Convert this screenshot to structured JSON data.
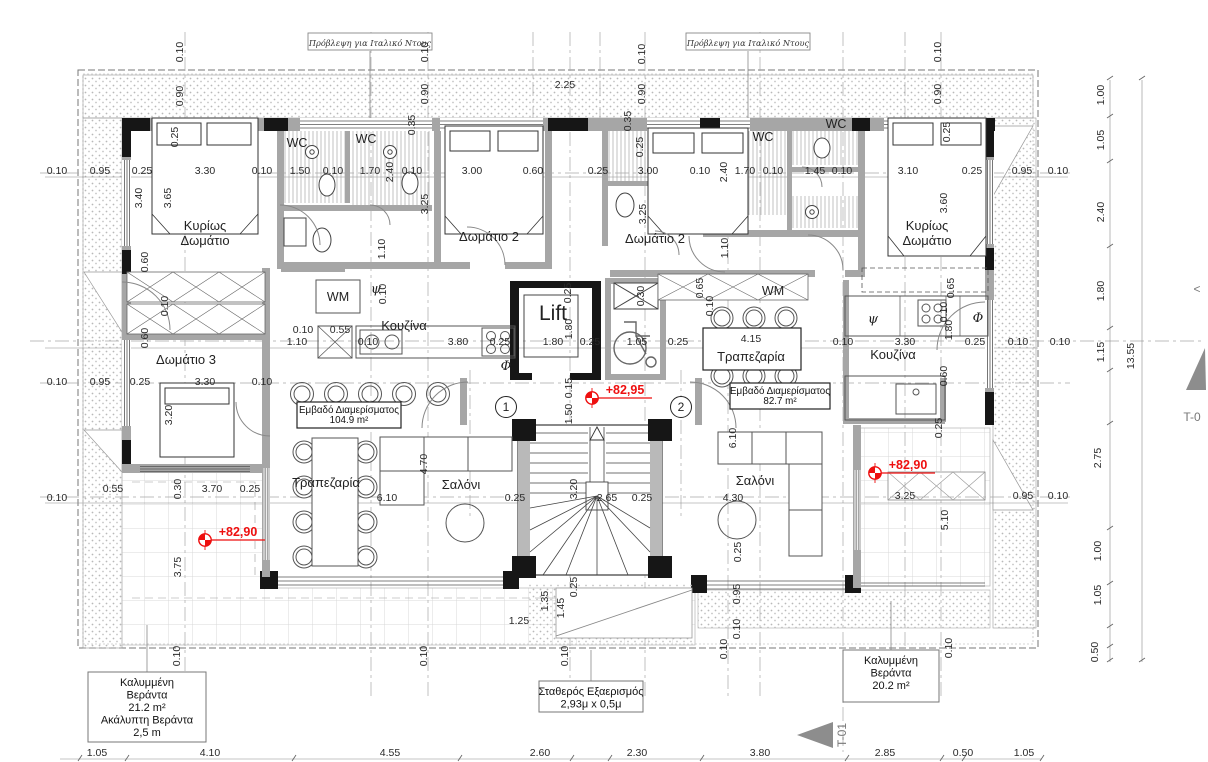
{
  "colors": {
    "accent_red": "#ee0f0f",
    "wall_gray": "#a6a6a6",
    "column_black": "#161616",
    "line_gray": "#8a8a8a"
  },
  "header_notes": [
    {
      "text": "Πρόβλεψη για Ιταλικό Ντους",
      "x": 370,
      "y": 43
    },
    {
      "text": "Πρόβλεψη για Ιταλικό Ντους",
      "x": 748,
      "y": 43
    }
  ],
  "rooms": [
    {
      "lines": [
        "Κυρίως",
        "Δωμάτιο"
      ],
      "x": 205,
      "y": 230
    },
    {
      "lines": [
        "Δωμάτιο 2"
      ],
      "x": 489,
      "y": 241
    },
    {
      "lines": [
        "Δωμάτιο 2"
      ],
      "x": 655,
      "y": 243
    },
    {
      "lines": [
        "Κυρίως",
        "Δωμάτιο"
      ],
      "x": 927,
      "y": 230
    },
    {
      "lines": [
        "Δωμάτιο 3"
      ],
      "x": 186,
      "y": 364
    },
    {
      "lines": [
        "Κουζίνα"
      ],
      "x": 404,
      "y": 330
    },
    {
      "lines": [
        "Κουζίνα"
      ],
      "x": 893,
      "y": 359
    },
    {
      "lines": [
        "Τραπεζαρία"
      ],
      "x": 326,
      "y": 487
    },
    {
      "lines": [
        "Τραπεζαρία"
      ],
      "x": 751,
      "y": 361
    },
    {
      "lines": [
        "Σαλόνι"
      ],
      "x": 461,
      "y": 489
    },
    {
      "lines": [
        "Σαλόνι"
      ],
      "x": 755,
      "y": 485
    }
  ],
  "fixtures": [
    {
      "t": "Lift",
      "x": 553,
      "y": 320,
      "cls": "lift"
    },
    {
      "t": "WC",
      "x": 297,
      "y": 147,
      "cls": "fixture"
    },
    {
      "t": "WC",
      "x": 366,
      "y": 143,
      "cls": "fixture"
    },
    {
      "t": "WC",
      "x": 763,
      "y": 141,
      "cls": "fixture"
    },
    {
      "t": "WC",
      "x": 836,
      "y": 128,
      "cls": "fixture"
    },
    {
      "t": "WM",
      "x": 338,
      "y": 301,
      "cls": "fixture"
    },
    {
      "t": "WM",
      "x": 773,
      "y": 295,
      "cls": "fixture"
    },
    {
      "t": "ψ",
      "x": 376,
      "y": 293,
      "cls": "greek-sym"
    },
    {
      "t": "ψ",
      "x": 873,
      "y": 323,
      "cls": "greek-sym"
    },
    {
      "t": "Φ",
      "x": 506,
      "y": 370,
      "cls": "greek-sym"
    },
    {
      "t": "Φ",
      "x": 978,
      "y": 322,
      "cls": "greek-sym"
    }
  ],
  "area_tags": [
    {
      "lines": [
        "Εμβαδό Διαμερίσματος",
        "104.9 m²"
      ],
      "x": 349,
      "y": 402,
      "w": 104,
      "h": 26
    },
    {
      "lines": [
        "Εμβαδό Διαμερίσματος",
        "82.7 m²"
      ],
      "x": 780,
      "y": 383,
      "w": 100,
      "h": 26
    }
  ],
  "info_boxes": [
    {
      "lines": [
        "Καλυμμένη",
        "Βεράντα",
        "21.2 m²",
        "Ακάλυπτη Βεράντα",
        "2,5 m"
      ],
      "x": 147,
      "y": 672,
      "w": 118,
      "h": 70,
      "leader": [
        147,
        625,
        147,
        672
      ]
    },
    {
      "lines": [
        "Σταθερός Εξαερισμός",
        "2,93μ x 0,5μ"
      ],
      "x": 591,
      "y": 681,
      "w": 104,
      "h": 31,
      "leader": [
        591,
        650,
        591,
        681
      ]
    },
    {
      "lines": [
        "Καλυμμένη",
        "Βεράντα",
        "20.2 m²"
      ],
      "x": 891,
      "y": 650,
      "w": 96,
      "h": 52,
      "leader": [
        891,
        601,
        891,
        650
      ]
    }
  ],
  "elevations": [
    {
      "t": "+82,95",
      "x": 592,
      "y": 398
    },
    {
      "t": "+82,90",
      "x": 875,
      "y": 473
    },
    {
      "t": "+82,90",
      "x": 205,
      "y": 540
    }
  ],
  "grid_bubbles": [
    {
      "t": "1",
      "x": 506,
      "y": 407
    },
    {
      "t": "2",
      "x": 681,
      "y": 407
    }
  ],
  "section_markers": [
    {
      "t": "T-01",
      "x": 846,
      "y": 735,
      "rot": -90,
      "tri": "833,722 833,748 797,735"
    },
    {
      "t": "T-0",
      "x": 1192,
      "y": 421,
      "rot": 0,
      "tri": "1205,348 1186,390 1206,390"
    },
    {
      "t": "<",
      "x": 1197,
      "y": 293,
      "rot": 0
    }
  ],
  "dims_h": [
    [
      "2.25",
      565,
      88
    ],
    [
      "0.10",
      57,
      174
    ],
    [
      "0.95",
      100,
      174
    ],
    [
      "0.25",
      142,
      174
    ],
    [
      "3.30",
      205,
      174
    ],
    [
      "0.10",
      262,
      174
    ],
    [
      "1.50",
      300,
      174
    ],
    [
      "0.10",
      333,
      174
    ],
    [
      "1.70",
      370,
      174
    ],
    [
      "0.10",
      412,
      174
    ],
    [
      "3.00",
      472,
      174
    ],
    [
      "0.60",
      533,
      174
    ],
    [
      "0.25",
      598,
      174
    ],
    [
      "3.00",
      648,
      174
    ],
    [
      "0.10",
      700,
      174
    ],
    [
      "1.70",
      745,
      174
    ],
    [
      "0.10",
      773,
      174
    ],
    [
      "1.45",
      815,
      174
    ],
    [
      "0.10",
      842,
      174
    ],
    [
      "3.10",
      908,
      174
    ],
    [
      "0.25",
      972,
      174
    ],
    [
      "0.95",
      1022,
      174
    ],
    [
      "0.10",
      1058,
      174
    ],
    [
      "0.10",
      303,
      333
    ],
    [
      "0.55",
      340,
      333
    ],
    [
      "1.10",
      297,
      345
    ],
    [
      "0.10",
      368,
      345
    ],
    [
      "3.80",
      458,
      345
    ],
    [
      "0.25",
      500,
      345
    ],
    [
      "1.80",
      553,
      345
    ],
    [
      "0.25",
      590,
      345
    ],
    [
      "1.05",
      637,
      345
    ],
    [
      "0.25",
      678,
      345
    ],
    [
      "4.15",
      751,
      342
    ],
    [
      "0.10",
      843,
      345
    ],
    [
      "3.30",
      905,
      345
    ],
    [
      "0.25",
      975,
      345
    ],
    [
      "0.10",
      1018,
      345
    ],
    [
      "0.10",
      1060,
      345
    ],
    [
      "0.10",
      57,
      385
    ],
    [
      "0.95",
      100,
      385
    ],
    [
      "0.25",
      140,
      385
    ],
    [
      "3.30",
      205,
      385
    ],
    [
      "0.10",
      262,
      385
    ],
    [
      "0.55",
      113,
      492
    ],
    [
      "3.70",
      212,
      492
    ],
    [
      "0.25",
      250,
      492
    ],
    [
      "0.10",
      57,
      501
    ],
    [
      "6.10",
      387,
      501
    ],
    [
      "0.25",
      515,
      501
    ],
    [
      "2.65",
      607,
      501
    ],
    [
      "0.25",
      642,
      501
    ],
    [
      "4.30",
      733,
      501
    ],
    [
      "3.25",
      905,
      499
    ],
    [
      "0.95",
      1023,
      499
    ],
    [
      "0.10",
      1058,
      499
    ],
    [
      "1.25",
      519,
      624
    ],
    [
      "1.05",
      97,
      756
    ],
    [
      "4.10",
      210,
      756
    ],
    [
      "4.55",
      390,
      756
    ],
    [
      "2.60",
      540,
      756
    ],
    [
      "2.30",
      637,
      756
    ],
    [
      "3.80",
      760,
      756
    ],
    [
      "2.85",
      885,
      756
    ],
    [
      "0.50",
      963,
      756
    ],
    [
      "1.05",
      1024,
      756
    ]
  ],
  "dims_v": [
    [
      "0.10",
      183,
      52
    ],
    [
      "0.90",
      183,
      96
    ],
    [
      "0.25",
      178,
      137
    ],
    [
      "0.10",
      428,
      52
    ],
    [
      "0.90",
      428,
      94
    ],
    [
      "0.35",
      415,
      125
    ],
    [
      "0.10",
      645,
      54
    ],
    [
      "0.90",
      645,
      94
    ],
    [
      "0.35",
      631,
      121
    ],
    [
      "0.25",
      643,
      147
    ],
    [
      "0.10",
      941,
      52
    ],
    [
      "0.90",
      941,
      94
    ],
    [
      "0.25",
      950,
      132
    ],
    [
      "2.40",
      393,
      172
    ],
    [
      "2.40",
      727,
      172
    ],
    [
      "3.40",
      142,
      198
    ],
    [
      "3.65",
      171,
      198
    ],
    [
      "0.60",
      148,
      262
    ],
    [
      "0.10",
      168,
      306
    ],
    [
      "0.60",
      148,
      338
    ],
    [
      "3.25",
      428,
      204
    ],
    [
      "3.25",
      646,
      214
    ],
    [
      "3.60",
      947,
      203
    ],
    [
      "1.10",
      385,
      249
    ],
    [
      "0.10",
      386,
      294
    ],
    [
      "1.10",
      728,
      248
    ],
    [
      "0.65",
      703,
      288
    ],
    [
      "0.65",
      954,
      288
    ],
    [
      "0.10",
      713,
      306
    ],
    [
      "0.10",
      947,
      312
    ],
    [
      "0.25",
      571,
      293
    ],
    [
      "1.80",
      572,
      329
    ],
    [
      "0.30",
      644,
      296
    ],
    [
      "0.15",
      572,
      388
    ],
    [
      "1.50",
      572,
      414
    ],
    [
      "3.20",
      577,
      489
    ],
    [
      "0.25",
      577,
      587
    ],
    [
      "1.35",
      548,
      601
    ],
    [
      "1.45",
      564,
      608
    ],
    [
      "6.10",
      736,
      438
    ],
    [
      "0.25",
      741,
      552
    ],
    [
      "0.95",
      740,
      594
    ],
    [
      "0.10",
      740,
      629
    ],
    [
      "4.70",
      427,
      464
    ],
    [
      "1.80",
      952,
      330
    ],
    [
      "0.60",
      947,
      376
    ],
    [
      "0.25",
      942,
      428
    ],
    [
      "5.10",
      948,
      520
    ],
    [
      "3.20",
      172,
      415
    ],
    [
      "0.30",
      181,
      489
    ],
    [
      "3.75",
      181,
      567
    ],
    [
      "0.10",
      180,
      656
    ],
    [
      "0.10",
      427,
      656
    ],
    [
      "0.10",
      568,
      656
    ],
    [
      "0.10",
      727,
      649
    ],
    [
      "0.10",
      952,
      648
    ],
    [
      "1.00",
      1104,
      95
    ],
    [
      "1.05",
      1104,
      140
    ],
    [
      "2.40",
      1104,
      212
    ],
    [
      "1.80",
      1104,
      291
    ],
    [
      "1.15",
      1104,
      352
    ],
    [
      "13.55",
      1134,
      356
    ],
    [
      "2.75",
      1101,
      458
    ],
    [
      "1.00",
      1101,
      551
    ],
    [
      "1.05",
      1101,
      595
    ],
    [
      "0.50",
      1098,
      652
    ]
  ]
}
